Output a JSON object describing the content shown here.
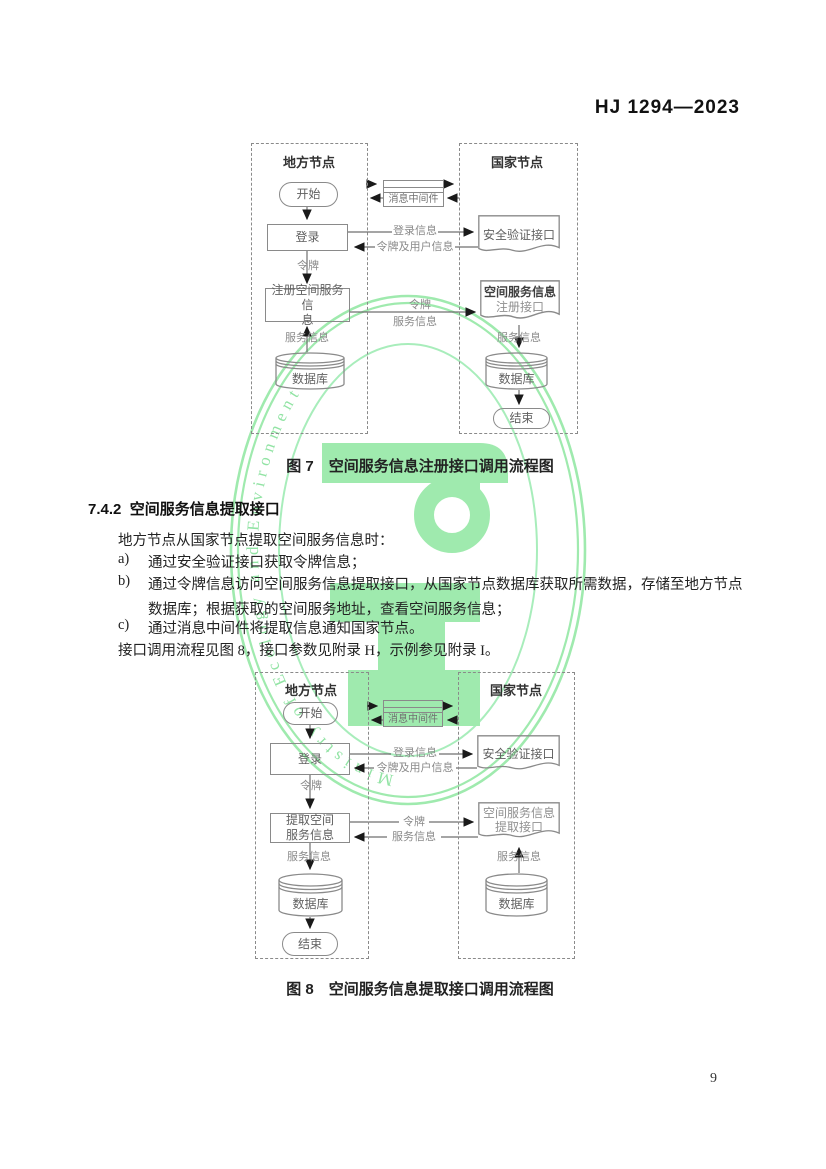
{
  "header": {
    "standard_number": "HJ 1294—2023"
  },
  "page_number": "9",
  "watermark": {
    "ring_text": "Ministry of Ecology and Environment",
    "glyph_color": "#8fe7a0",
    "ring_color": "#8fe7a0"
  },
  "figure7": {
    "caption": "图 7　空间服务信息注册接口调用流程图",
    "left_column": "地方节点",
    "right_column": "国家节点",
    "nodes": {
      "start": "开始",
      "middleware": "消息中间件",
      "login": "登录",
      "auth_interface": "安全验证接口",
      "register_box": "注册空间服务信\n息",
      "register_interface_line1": "空间服务信息",
      "register_interface_line2": "注册接口",
      "db_left": "数据库",
      "db_right": "数据库",
      "end": "结束"
    },
    "labels": {
      "login_info": "登录信息",
      "token_and_user": "令牌及用户信息",
      "token_down": "令牌",
      "token_mid": "令牌",
      "service_info_mid": "服务信息",
      "service_info_left": "服务信息",
      "service_info_right": "服务信息"
    }
  },
  "section": {
    "number": "7.4.2",
    "title": "空间服务信息提取接口",
    "intro": "地方节点从国家节点提取空间服务信息时：",
    "items": [
      {
        "marker": "a)",
        "lines": [
          "通过安全验证接口获取令牌信息；"
        ]
      },
      {
        "marker": "b)",
        "lines": [
          "通过令牌信息访问空间服务信息提取接口，从国家节点数据库获取所需数据，存储至地方节点",
          "数据库；根据获取的空间服务地址，查看空间服务信息；"
        ]
      },
      {
        "marker": "c)",
        "lines": [
          "通过消息中间件将提取信息通知国家节点。"
        ]
      }
    ],
    "outro": "接口调用流程见图 8，接口参数见附录 H，示例参见附录 I。"
  },
  "figure8": {
    "caption": "图 8　空间服务信息提取接口调用流程图",
    "left_column": "地方节点",
    "right_column": "国家节点",
    "nodes": {
      "start": "开始",
      "middleware": "消息中间件",
      "login": "登录",
      "auth_interface": "安全验证接口",
      "extract_box": "提取空间\n服务信息",
      "extract_interface_line1": "空间服务信息",
      "extract_interface_line2": "提取接口",
      "db_left": "数据库",
      "db_right": "数据库",
      "end": "结束"
    },
    "labels": {
      "login_info": "登录信息",
      "token_and_user": "令牌及用户信息",
      "token_down": "令牌",
      "token_mid": "令牌",
      "service_info_mid": "服务信息",
      "service_info_left": "服务信息",
      "service_info_right": "服务信息"
    }
  }
}
